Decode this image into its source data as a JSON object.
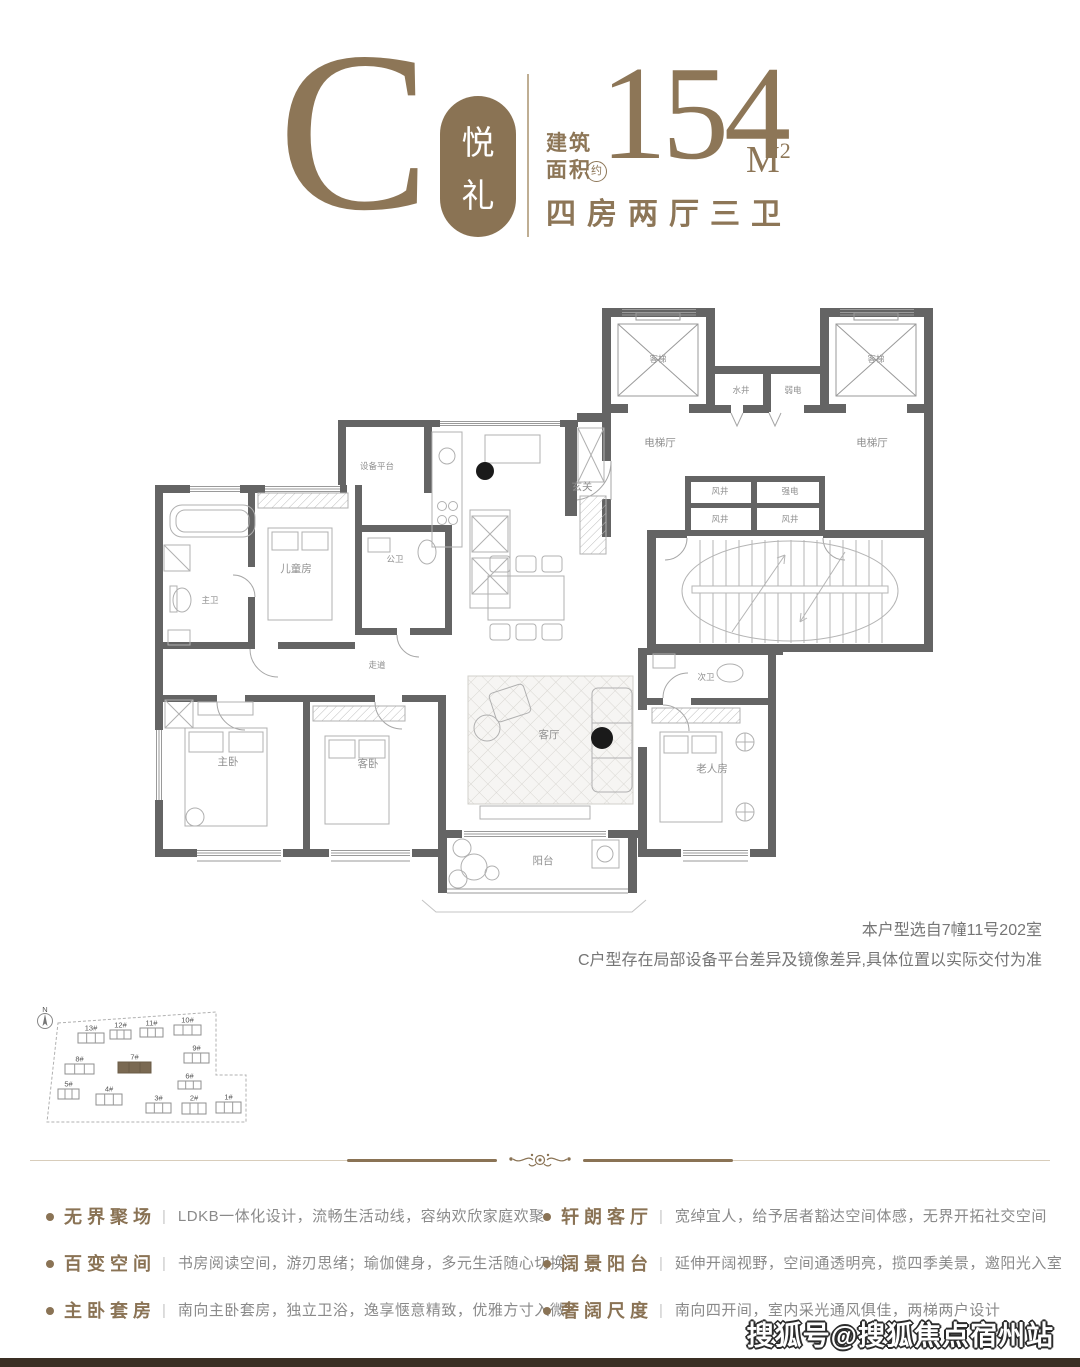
{
  "header": {
    "type_letter": "C",
    "badge_chars": [
      "悦",
      "礼"
    ],
    "area_label_line1": "建筑",
    "area_label_line2": "面积",
    "area_approx_char": "约",
    "area_value": "154",
    "area_unit_letter": "M",
    "area_unit_sup": "2",
    "layout_text": "四房两厅三卫"
  },
  "floorplan": {
    "rooms": [
      {
        "label": "客梯",
        "x": 518,
        "y": 62,
        "small": true
      },
      {
        "label": "客梯",
        "x": 736,
        "y": 62,
        "small": true
      },
      {
        "label": "水井",
        "x": 601,
        "y": 93,
        "small": true
      },
      {
        "label": "弱电",
        "x": 653,
        "y": 93,
        "small": true
      },
      {
        "label": "电梯厅",
        "x": 520,
        "y": 146
      },
      {
        "label": "电梯厅",
        "x": 732,
        "y": 146
      },
      {
        "label": "风井",
        "x": 580,
        "y": 194,
        "small": true
      },
      {
        "label": "强电",
        "x": 650,
        "y": 194,
        "small": true
      },
      {
        "label": "风井",
        "x": 580,
        "y": 222,
        "small": true
      },
      {
        "label": "风井",
        "x": 650,
        "y": 222,
        "small": true
      },
      {
        "label": "设备平台",
        "x": 237,
        "y": 169,
        "small": true
      },
      {
        "label": "玄关",
        "x": 442,
        "y": 190
      },
      {
        "label": "主卫",
        "x": 70,
        "y": 303,
        "small": true
      },
      {
        "label": "儿童房",
        "x": 156,
        "y": 272
      },
      {
        "label": "公卫",
        "x": 255,
        "y": 262,
        "small": true
      },
      {
        "label": "走道",
        "x": 237,
        "y": 368,
        "small": true
      },
      {
        "label": "主卧",
        "x": 88,
        "y": 465
      },
      {
        "label": "客卧",
        "x": 228,
        "y": 467
      },
      {
        "label": "客厅",
        "x": 409,
        "y": 438
      },
      {
        "label": "次卫",
        "x": 566,
        "y": 380,
        "small": true
      },
      {
        "label": "老人房",
        "x": 572,
        "y": 472
      },
      {
        "label": "阳台",
        "x": 403,
        "y": 564
      }
    ],
    "note_line1": "本户型选自7幢11号202室",
    "note_line2": "C户型存在局部设备平台差异及镜像差异,具体位置以实际交付为准"
  },
  "sitemap": {
    "compass_label": "N",
    "buildings": [
      {
        "label": "13#",
        "x": 45,
        "y": 27,
        "w": 26,
        "h": 10
      },
      {
        "label": "12#",
        "x": 77,
        "y": 24,
        "w": 21,
        "h": 9
      },
      {
        "label": "11#",
        "x": 107,
        "y": 22,
        "w": 23,
        "h": 9
      },
      {
        "label": "10#",
        "x": 141,
        "y": 19,
        "w": 27,
        "h": 10
      },
      {
        "label": "9#",
        "x": 151,
        "y": 47,
        "w": 25,
        "h": 10
      },
      {
        "label": "8#",
        "x": 32,
        "y": 58,
        "w": 29,
        "h": 10
      },
      {
        "label": "7#",
        "x": 85,
        "y": 56,
        "w": 33,
        "h": 11,
        "dark": true
      },
      {
        "label": "6#",
        "x": 145,
        "y": 75,
        "w": 23,
        "h": 8
      },
      {
        "label": "5#",
        "x": 25,
        "y": 83,
        "w": 21,
        "h": 10
      },
      {
        "label": "4#",
        "x": 63,
        "y": 88,
        "w": 26,
        "h": 11
      },
      {
        "label": "3#",
        "x": 113,
        "y": 97,
        "w": 25,
        "h": 10
      },
      {
        "label": "2#",
        "x": 149,
        "y": 97,
        "w": 24,
        "h": 11
      },
      {
        "label": "1#",
        "x": 183,
        "y": 96,
        "w": 25,
        "h": 11
      }
    ]
  },
  "features": {
    "left": [
      {
        "title": "无界聚场",
        "desc": "LDKB一体化设计，流畅生活动线，容纳欢欣家庭欢聚"
      },
      {
        "title": "百变空间",
        "desc": "书房阅读空间，游刃思绪；瑜伽健身，多元生活随心切换"
      },
      {
        "title": "主卧套房",
        "desc": "南向主卧套房，独立卫浴，逸享惬意精致，优雅方寸入微"
      }
    ],
    "right": [
      {
        "title": "轩朗客厅",
        "desc": "宽绰宜人，给予居者豁达空间体感，无界开拓社交空间"
      },
      {
        "title": "阔景阳台",
        "desc": "延伸开阔视野，空间通透明亮，揽四季美景，邀阳光入室"
      },
      {
        "title": "奢阔尺度",
        "desc": "南向四开间，室内采光通风俱佳，两梯两户设计"
      }
    ]
  },
  "watermark_text": "搜狐号@搜狐焦点宿州站",
  "colors": {
    "brand": "#8a7355",
    "serif_brown": "#8d7657",
    "wall": "#646464",
    "thin_line": "#a8a8a8",
    "desc_gray": "#8a8a8a",
    "bottom_bar": "#3a2f24"
  }
}
